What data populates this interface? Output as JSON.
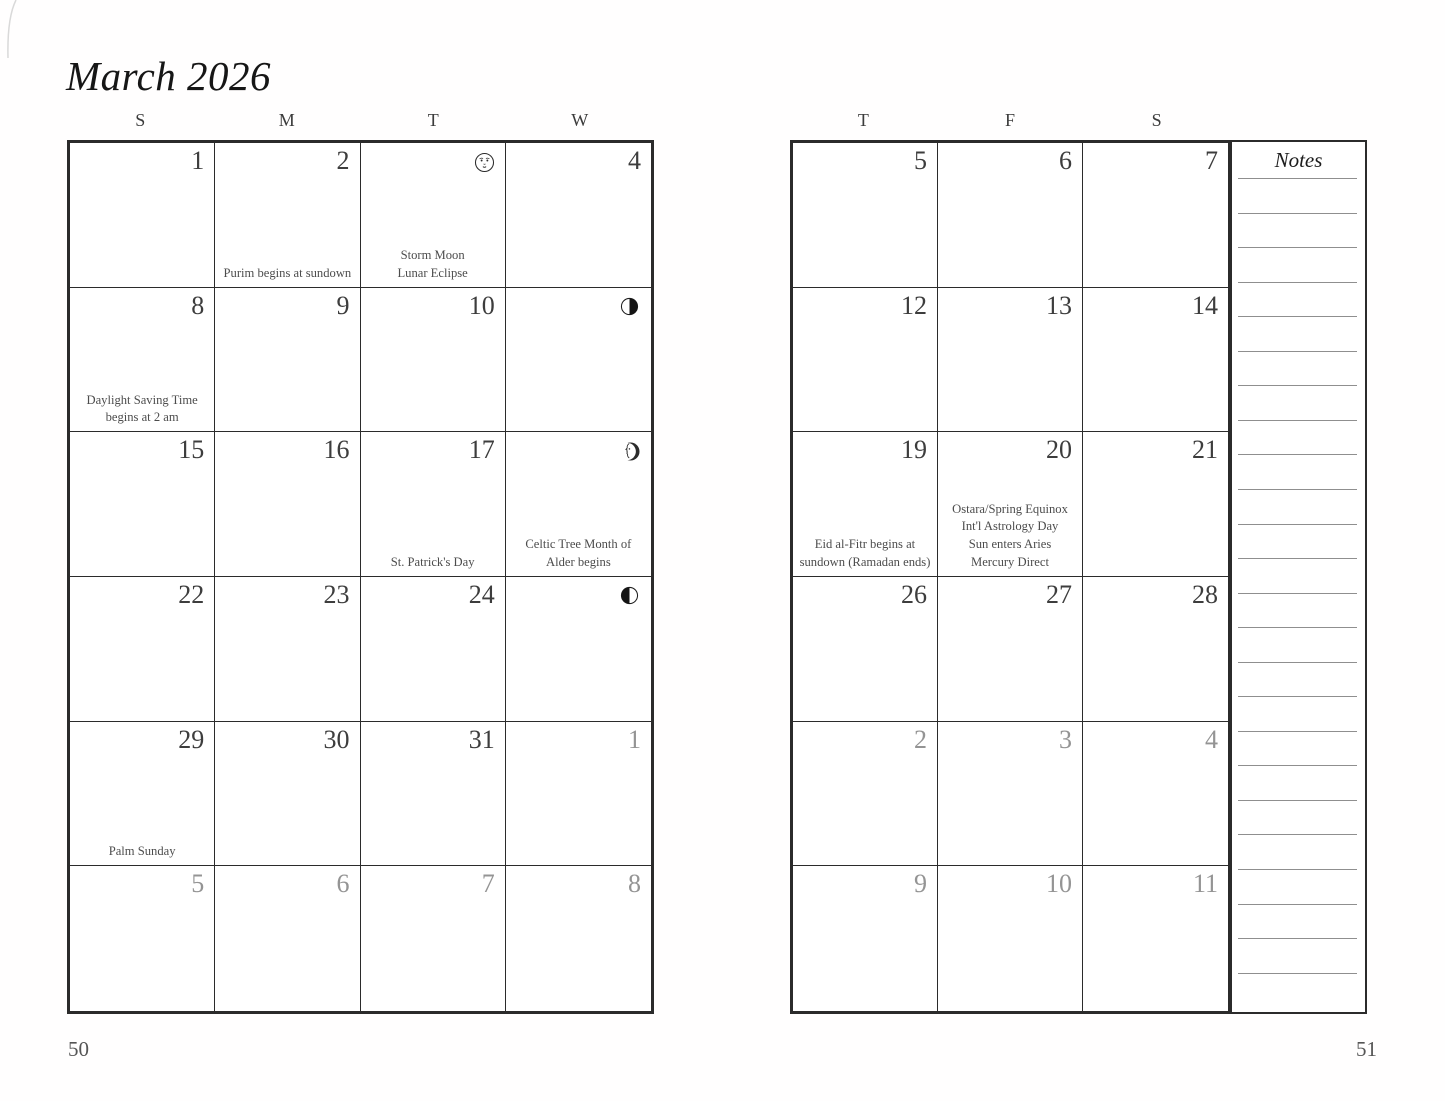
{
  "title": "March 2026",
  "page_numbers": {
    "left": "50",
    "right": "51"
  },
  "notes": {
    "label": "Notes",
    "line_count": 24
  },
  "colors": {
    "ink": "#2b2b2b",
    "day_number": "#3d3d3d",
    "muted_day_number": "#949494",
    "event_text": "#4c4c4c",
    "note_line": "#8f8f8f"
  },
  "left_page": {
    "day_headers": [
      "S",
      "M",
      "T",
      "W"
    ],
    "weeks": [
      [
        {
          "day": "1"
        },
        {
          "day": "2",
          "events": [
            "Purim begins at sundown"
          ]
        },
        {
          "day": "",
          "icon": "full-moon-face",
          "events": [
            "Storm Moon",
            "Lunar Eclipse"
          ]
        },
        {
          "day": "4"
        }
      ],
      [
        {
          "day": "8",
          "events": [
            "Daylight Saving Time",
            "begins at 2 am"
          ]
        },
        {
          "day": "9"
        },
        {
          "day": "10"
        },
        {
          "day": "",
          "icon": "last-quarter-moon"
        }
      ],
      [
        {
          "day": "15"
        },
        {
          "day": "16"
        },
        {
          "day": "17",
          "events": [
            "St. Patrick's Day"
          ]
        },
        {
          "day": "",
          "icon": "new-moon-face",
          "events": [
            "Celtic Tree Month of",
            "Alder begins"
          ]
        }
      ],
      [
        {
          "day": "22"
        },
        {
          "day": "23"
        },
        {
          "day": "24"
        },
        {
          "day": "",
          "icon": "first-quarter-moon"
        }
      ],
      [
        {
          "day": "29",
          "events": [
            "Palm Sunday"
          ]
        },
        {
          "day": "30"
        },
        {
          "day": "31"
        },
        {
          "day": "1",
          "muted": true
        }
      ],
      [
        {
          "day": "5",
          "muted": true
        },
        {
          "day": "6",
          "muted": true
        },
        {
          "day": "7",
          "muted": true
        },
        {
          "day": "8",
          "muted": true
        }
      ]
    ]
  },
  "right_page": {
    "day_headers": [
      "T",
      "F",
      "S"
    ],
    "weeks": [
      [
        {
          "day": "5"
        },
        {
          "day": "6"
        },
        {
          "day": "7"
        }
      ],
      [
        {
          "day": "12"
        },
        {
          "day": "13"
        },
        {
          "day": "14"
        }
      ],
      [
        {
          "day": "19",
          "events": [
            "Eid al-Fitr begins at",
            "sundown (Ramadan ends)"
          ]
        },
        {
          "day": "20",
          "events": [
            "Ostara/Spring Equinox",
            "Int'l Astrology Day",
            "Sun enters Aries",
            "Mercury Direct"
          ]
        },
        {
          "day": "21"
        }
      ],
      [
        {
          "day": "26"
        },
        {
          "day": "27"
        },
        {
          "day": "28"
        }
      ],
      [
        {
          "day": "2",
          "muted": true
        },
        {
          "day": "3",
          "muted": true
        },
        {
          "day": "4",
          "muted": true
        }
      ],
      [
        {
          "day": "9",
          "muted": true
        },
        {
          "day": "10",
          "muted": true
        },
        {
          "day": "11",
          "muted": true
        }
      ]
    ]
  }
}
